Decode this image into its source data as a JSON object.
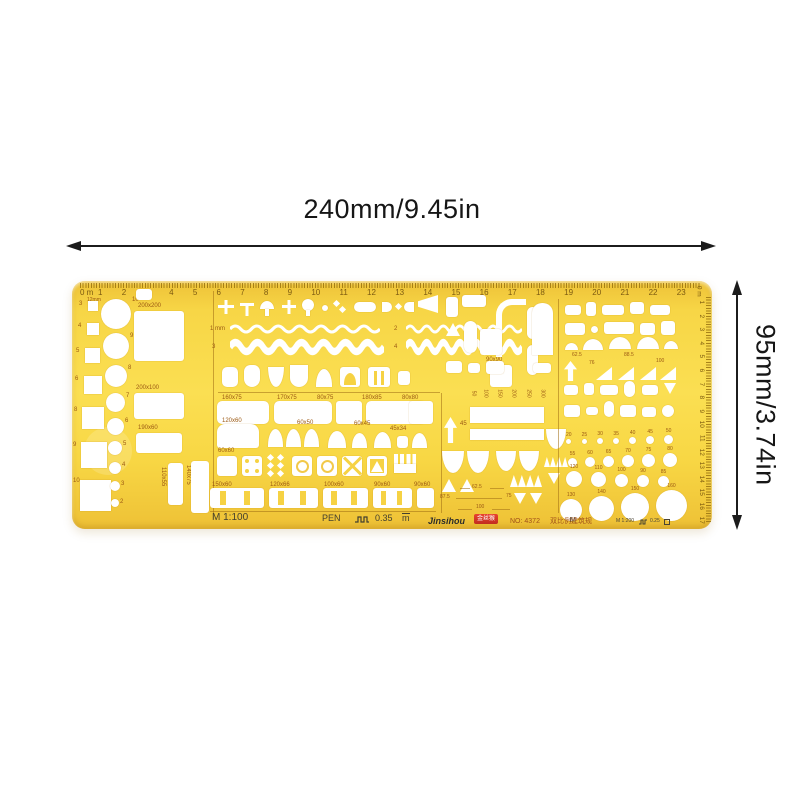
{
  "annotations": {
    "width_label": "240mm/9.45in",
    "height_label": "95mm/3.74in"
  },
  "template": {
    "top_scale": {
      "zero": "0 m",
      "note": "12mm",
      "numbers": [
        "1",
        "2",
        "3",
        "4",
        "5",
        "6",
        "7",
        "8",
        "9",
        "10",
        "11",
        "12",
        "13",
        "14",
        "15",
        "16",
        "17",
        "18",
        "19",
        "20",
        "21",
        "22",
        "23"
      ]
    },
    "right_scale": {
      "zero": "0 m",
      "numbers": [
        "1",
        "2",
        "3",
        "4",
        "5",
        "6",
        "7",
        "8",
        "9",
        "10",
        "11",
        "12",
        "13",
        "14",
        "15",
        "16",
        "17"
      ]
    },
    "left_squares_labels": [
      "3",
      "4",
      "5",
      "6",
      "8",
      "9",
      "10"
    ],
    "left_circles_labels": [
      "10",
      "9",
      "8",
      "7",
      "6",
      "5",
      "4",
      "3",
      "2"
    ],
    "big_rect_labels": [
      "200x200",
      "200x100",
      "190x60"
    ],
    "vertical_rect_labels": [
      "110x55",
      "140x75"
    ],
    "wave_labels": [
      "1 mm",
      "2",
      "3",
      "4"
    ],
    "row1_labels": [
      "160x75",
      "170x75",
      "80x75",
      "180x85",
      "80x80"
    ],
    "row2_labels": [
      "120x60",
      "60x50",
      "60x45",
      "45x34"
    ],
    "row3_label": "60x60",
    "row4_labels": [
      "150x60",
      "120x66",
      "100x60",
      "90x60",
      "90x60"
    ],
    "label_90x90": "90x90",
    "mid_scale_numbers": [
      "50",
      "100",
      "150",
      "200",
      "250",
      "300"
    ],
    "label_45": "45",
    "mid_dim_labels": [
      "62.5",
      "87.5",
      "75",
      "100"
    ],
    "right_arc_labels": [
      "62.5",
      "88.5"
    ],
    "right_tri_labels": [
      "76",
      "100"
    ],
    "circle_grid": {
      "row1": [
        "20",
        "25",
        "30",
        "35",
        "40",
        "45",
        "50"
      ],
      "row2": [
        "55",
        "60",
        "65",
        "70",
        "75",
        "80"
      ],
      "row3": [
        "120",
        "110",
        "100",
        "90",
        "85"
      ],
      "row4": [
        "130",
        "140",
        "150",
        "160"
      ]
    },
    "m_label": "M",
    "footer": {
      "scale_main": "M 1:100",
      "pen": "PEN",
      "pen_width": "0.35",
      "unit": "m",
      "brand": "Jinsihou",
      "brand_logo": "金丝猴",
      "model_no": "NO: 4372",
      "product_name_cn": "双比例建筑规",
      "scale_secondary": "M 1:200",
      "pen_width_secondary": "0.25"
    }
  }
}
